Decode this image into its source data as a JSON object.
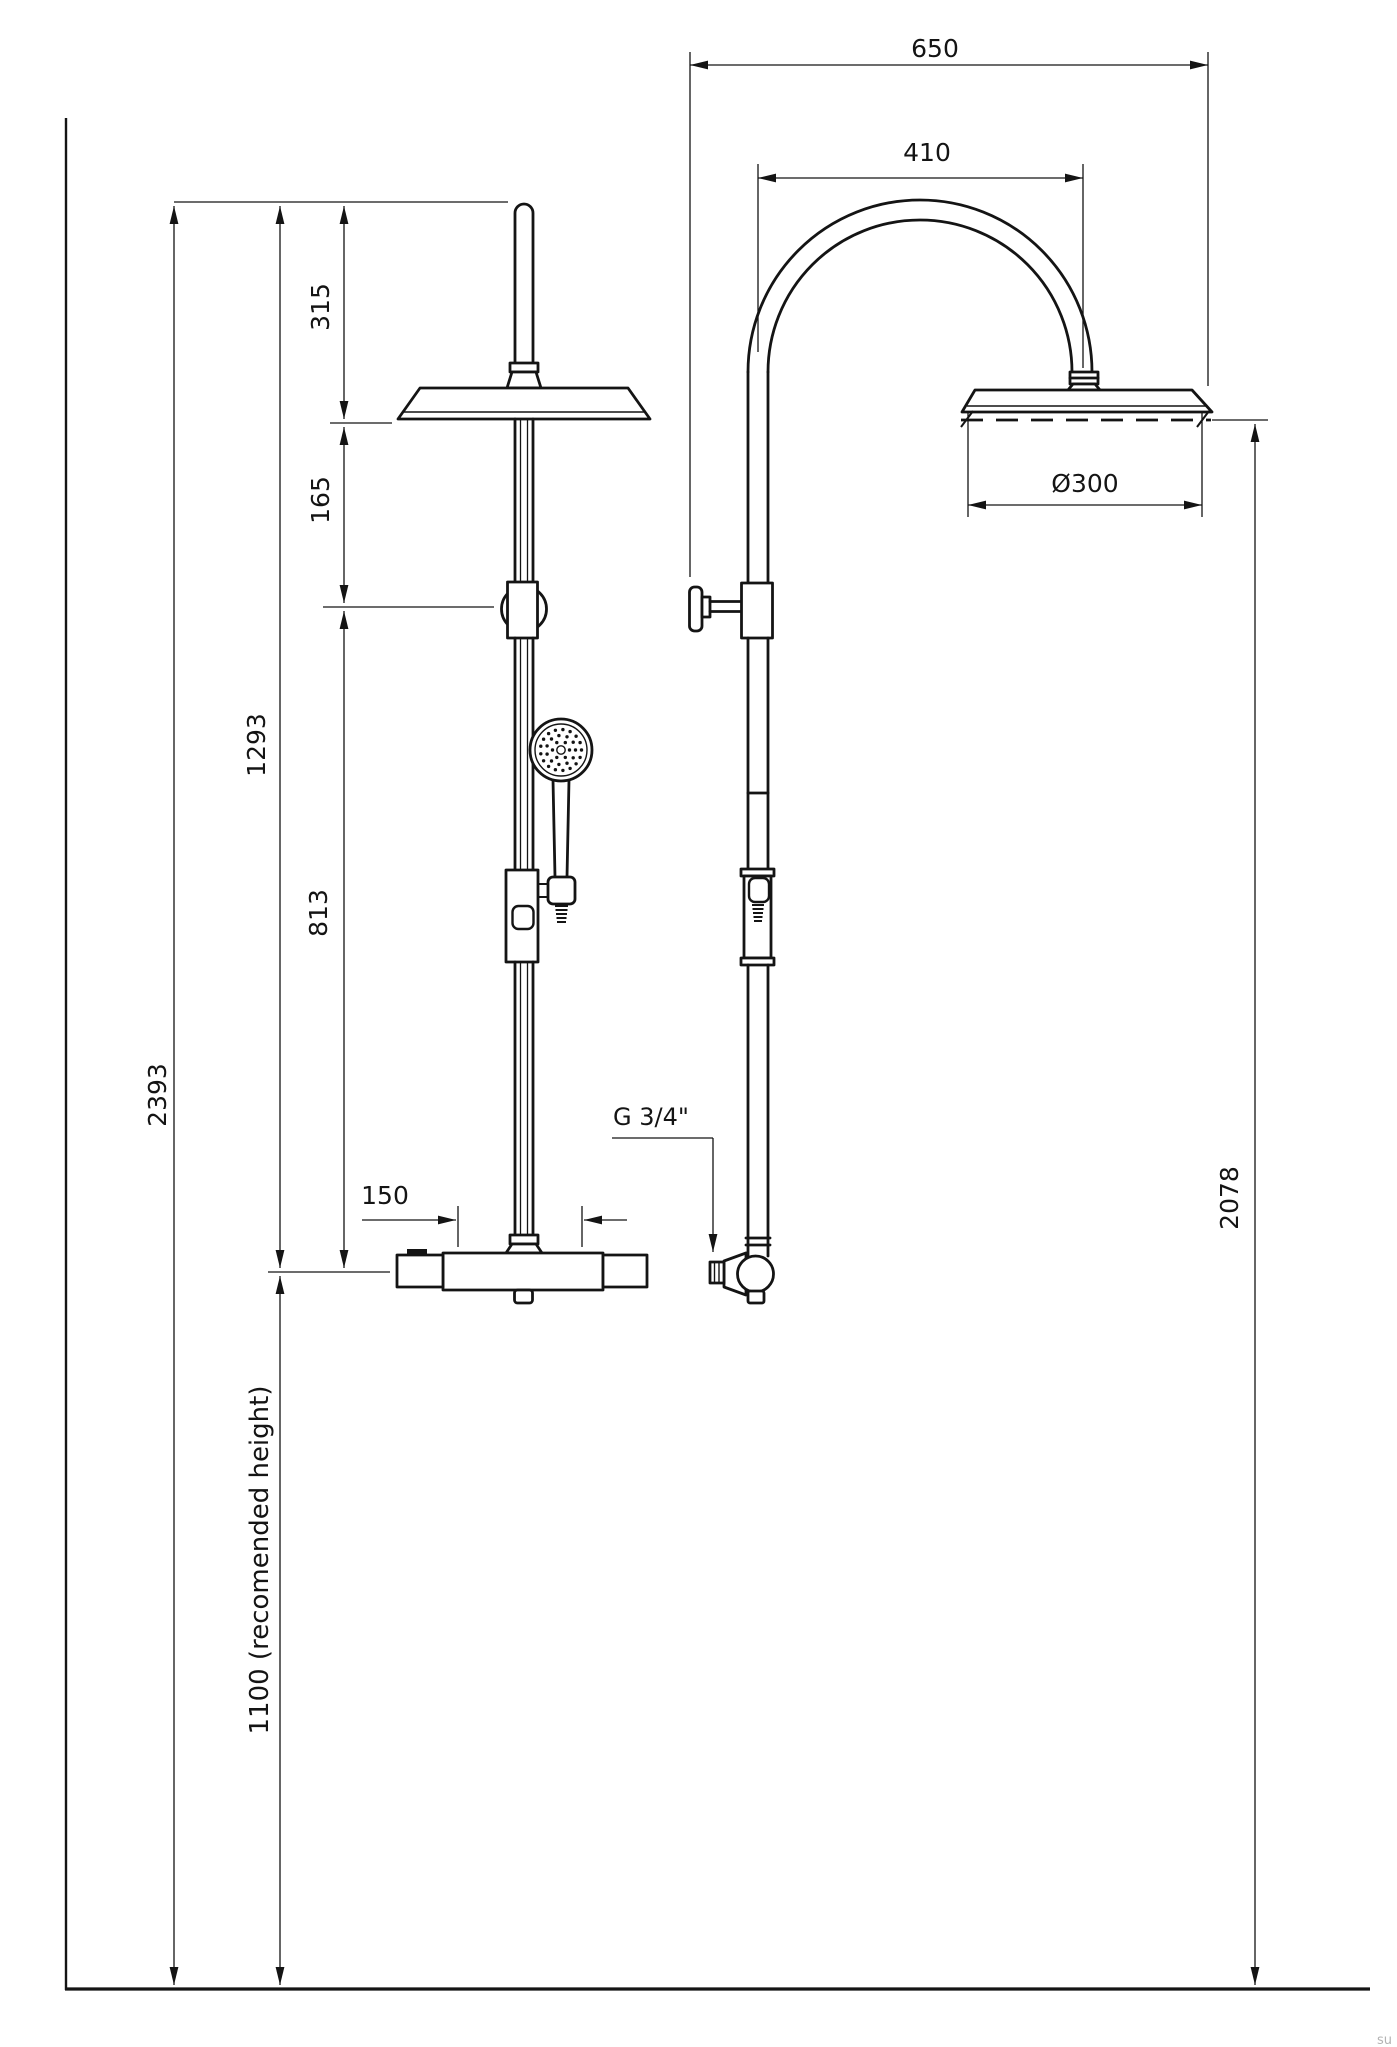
{
  "drawing": {
    "type": "technical-dimension-drawing",
    "subject": "shower-column-with-overhead-and-hand-shower",
    "views": [
      "front-view",
      "side-view"
    ]
  },
  "colors": {
    "line": "#141414",
    "watermark": "#b3b3b3"
  },
  "labels": {
    "dim_650": "650",
    "dim_410": "410",
    "dim_diameter": "Ø300",
    "dim_315": "315",
    "dim_165": "165",
    "dim_1293": "1293",
    "dim_813": "813",
    "dim_2393": "2393",
    "dim_1100": "1100 (recomended height)",
    "dim_2078": "2078",
    "dim_150": "150",
    "thread_size": "G 3/4\"",
    "watermark": "su"
  }
}
